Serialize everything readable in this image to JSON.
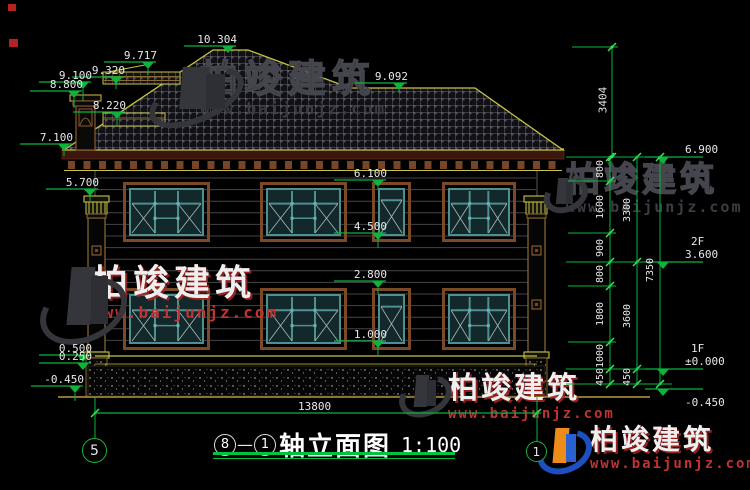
{
  "title": {
    "axis_a": "8",
    "axis_b": "1",
    "text": "轴立面图",
    "scale": "1:100"
  },
  "axis_bubbles": [
    {
      "label": "5",
      "x": 95,
      "y": 451,
      "r": 13,
      "fs": 14
    },
    {
      "label": "1",
      "x": 537,
      "y": 452,
      "r": 11,
      "fs": 12
    }
  ],
  "bottom_dim": {
    "label": "13800",
    "x1": 95,
    "x2": 537,
    "y": 413,
    "label_x": 316,
    "label_y": 401
  },
  "top_dim": {
    "label": "3404",
    "x": 612,
    "y1": 47,
    "y2": 157,
    "label_y": 100
  },
  "right_chains": [
    {
      "x": 610,
      "ticks": [
        157,
        181,
        233,
        262,
        286,
        342,
        369,
        384
      ],
      "labels": [
        "800",
        "1600",
        "900",
        "800",
        "1800",
        "1000",
        "450"
      ]
    },
    {
      "x": 637,
      "ticks": [
        157,
        262,
        369,
        384
      ],
      "labels": [
        "3300",
        "3600",
        "450"
      ]
    },
    {
      "x": 660,
      "ticks": [
        157,
        384
      ],
      "labels": [
        "7350"
      ],
      "label_centers": [
        270
      ]
    }
  ],
  "ext_lines": [
    {
      "y": 157,
      "x1": 566,
      "x2": 672
    },
    {
      "y": 262,
      "x1": 566,
      "x2": 672
    },
    {
      "y": 369,
      "x1": 566,
      "x2": 672
    },
    {
      "y": 384,
      "x1": 566,
      "x2": 672
    },
    {
      "y": 181,
      "x1": 568,
      "x2": 616
    },
    {
      "y": 233,
      "x1": 568,
      "x2": 616
    },
    {
      "y": 286,
      "x1": 568,
      "x2": 616
    },
    {
      "y": 342,
      "x1": 568,
      "x2": 616
    },
    {
      "y": 47,
      "x1": 572,
      "x2": 618
    }
  ],
  "markers_left": [
    {
      "label": "10.304",
      "x": 228,
      "y": 46,
      "leader": 0
    },
    {
      "label": "9.717",
      "x": 148,
      "y": 62,
      "leader": 6
    },
    {
      "label": "9.320",
      "x": 116,
      "y": 77,
      "leader": 5
    },
    {
      "label": "9.100",
      "x": 83,
      "y": 82,
      "leader": 12
    },
    {
      "label": "8.800",
      "x": 74,
      "y": 91,
      "leader": 10
    },
    {
      "label": "8.220",
      "x": 117,
      "y": 112,
      "leader": 6
    },
    {
      "label": "7.100",
      "x": 64,
      "y": 144,
      "leader": 5
    },
    {
      "label": "5.700",
      "x": 90,
      "y": 189,
      "leader": 6
    },
    {
      "label": "9.092",
      "x": 399,
      "y": 83,
      "leader": 3
    },
    {
      "label": "6.100",
      "x": 378,
      "y": 180,
      "leader": 3
    },
    {
      "label": "4.500",
      "x": 378,
      "y": 233,
      "leader": 8
    },
    {
      "label": "2.800",
      "x": 378,
      "y": 281,
      "leader": 6
    },
    {
      "label": "1.000",
      "x": 378,
      "y": 341,
      "leader": 7
    },
    {
      "label": "0.500",
      "x": 83,
      "y": 355,
      "leader": 0
    },
    {
      "label": "0.250",
      "x": 83,
      "y": 363,
      "leader": 0
    },
    {
      "label": "-0.450",
      "x": 75,
      "y": 386,
      "leader": 8
    }
  ],
  "markers_right": [
    {
      "label": "6.900",
      "x": 663,
      "y": 157
    },
    {
      "label": "3.600",
      "floor": "2F",
      "x": 663,
      "y": 262
    },
    {
      "label": "±0.000",
      "floor": "1F",
      "x": 663,
      "y": 369
    },
    {
      "label": "-0.450",
      "x": 663,
      "y": 389,
      "below": true
    }
  ],
  "watermarks": [
    {
      "style": "dark",
      "text": "柏竣建筑",
      "url": "www.baijunjz.com",
      "x": 200,
      "y": 60,
      "fs": 38,
      "ufs": 16,
      "ls": 6,
      "logo": {
        "x": 146,
        "y": 64,
        "w": 104,
        "h": 58,
        "color": false
      }
    },
    {
      "style": "dark",
      "text": "柏竣建筑",
      "url": "www.baijunjz.com",
      "x": 566,
      "y": 163,
      "fs": 34,
      "ufs": 15,
      "ls": 4,
      "logo": {
        "x": 543,
        "y": 176,
        "w": 40,
        "h": 36,
        "color": false
      }
    },
    {
      "style": "light",
      "text": "柏竣建筑",
      "url": "www.baijunjz.com",
      "x": 92,
      "y": 266,
      "fs": 36,
      "ufs": 16,
      "ls": 5,
      "logo": {
        "x": 38,
        "y": 262,
        "w": 92,
        "h": 80,
        "color": false
      }
    },
    {
      "style": "light",
      "text": "柏竣建筑",
      "url": "www.baijunjz.com",
      "x": 448,
      "y": 374,
      "fs": 30,
      "ufs": 14,
      "ls": 3,
      "logo": {
        "x": 398,
        "y": 372,
        "w": 50,
        "h": 44,
        "color": false
      }
    },
    {
      "style": "light",
      "text": "柏竣建筑",
      "url": "www.baijunjz.com",
      "x": 590,
      "y": 426,
      "fs": 28,
      "ufs": 14,
      "ls": 3,
      "logo": {
        "x": 536,
        "y": 425,
        "w": 52,
        "h": 48,
        "color": true
      }
    }
  ],
  "geometry": {
    "roof_poly": "64,150 213,50 248,50 350,88 475,88 563,150",
    "ridge_aux": [
      [
        108,
        72
      ],
      [
        150,
        64
      ]
    ],
    "eave": {
      "x1": 62,
      "x2": 564,
      "y_top": 149,
      "band_h": 9,
      "dentil_y": 161,
      "dentil_w": 7,
      "dentil_h": 8,
      "dentil_step": 15.5,
      "y_bot": 170.5
    },
    "band_a": {
      "x": 103,
      "y": 72,
      "w": 77,
      "h": 12
    },
    "band_b": {
      "x": 103,
      "y": 113,
      "w": 62,
      "h": 13
    },
    "chimney": {
      "cap": [
        70,
        95,
        31,
        6
      ],
      "cap2": [
        73,
        101,
        25,
        5
      ],
      "body": [
        76,
        106,
        19,
        44
      ],
      "inner": [
        79,
        109,
        13,
        17
      ]
    },
    "wall": {
      "x1": 95,
      "x2": 537,
      "y1": 171,
      "y2": 356
    },
    "siding": {
      "y0": 178,
      "step": 11.6,
      "n": 15
    },
    "base_lines": [
      356,
      364
    ],
    "plinth": {
      "x": 88,
      "y": 366,
      "w": 457,
      "h": 30
    },
    "ground": {
      "x1": 58,
      "x2": 650,
      "y": 397
    },
    "pillars": [
      {
        "x": 84
      },
      {
        "x": 524
      }
    ],
    "windows_2f": {
      "y": 182,
      "h": 60,
      "items": [
        {
          "x": 123,
          "w": 87
        },
        {
          "x": 260,
          "w": 87
        },
        {
          "x": 372,
          "w": 39,
          "narrow": true
        },
        {
          "x": 442,
          "w": 74
        }
      ]
    },
    "windows_1f": {
      "y": 288,
      "h": 62,
      "items": [
        {
          "x": 123,
          "w": 87
        },
        {
          "x": 260,
          "w": 87
        },
        {
          "x": 372,
          "w": 39,
          "narrow": true
        },
        {
          "x": 442,
          "w": 74
        }
      ]
    }
  },
  "red_marks": [
    {
      "x": 8,
      "y": 4,
      "w": 8,
      "h": 7
    },
    {
      "x": 9,
      "y": 39,
      "w": 9,
      "h": 8
    }
  ],
  "colors": {
    "green": "#0cb43a",
    "green_bright": "#39e65a",
    "yellow": "#c8c343",
    "brown": "#7a4a28",
    "maroon": "#3a160c",
    "dentil": "#7a4526",
    "teal": "#4e8f8f",
    "teal_fill": "#13282a",
    "glass_line": "#a8baba",
    "siding": "#45454a",
    "white": "#e8e8e8",
    "ground": "#8a7430"
  }
}
